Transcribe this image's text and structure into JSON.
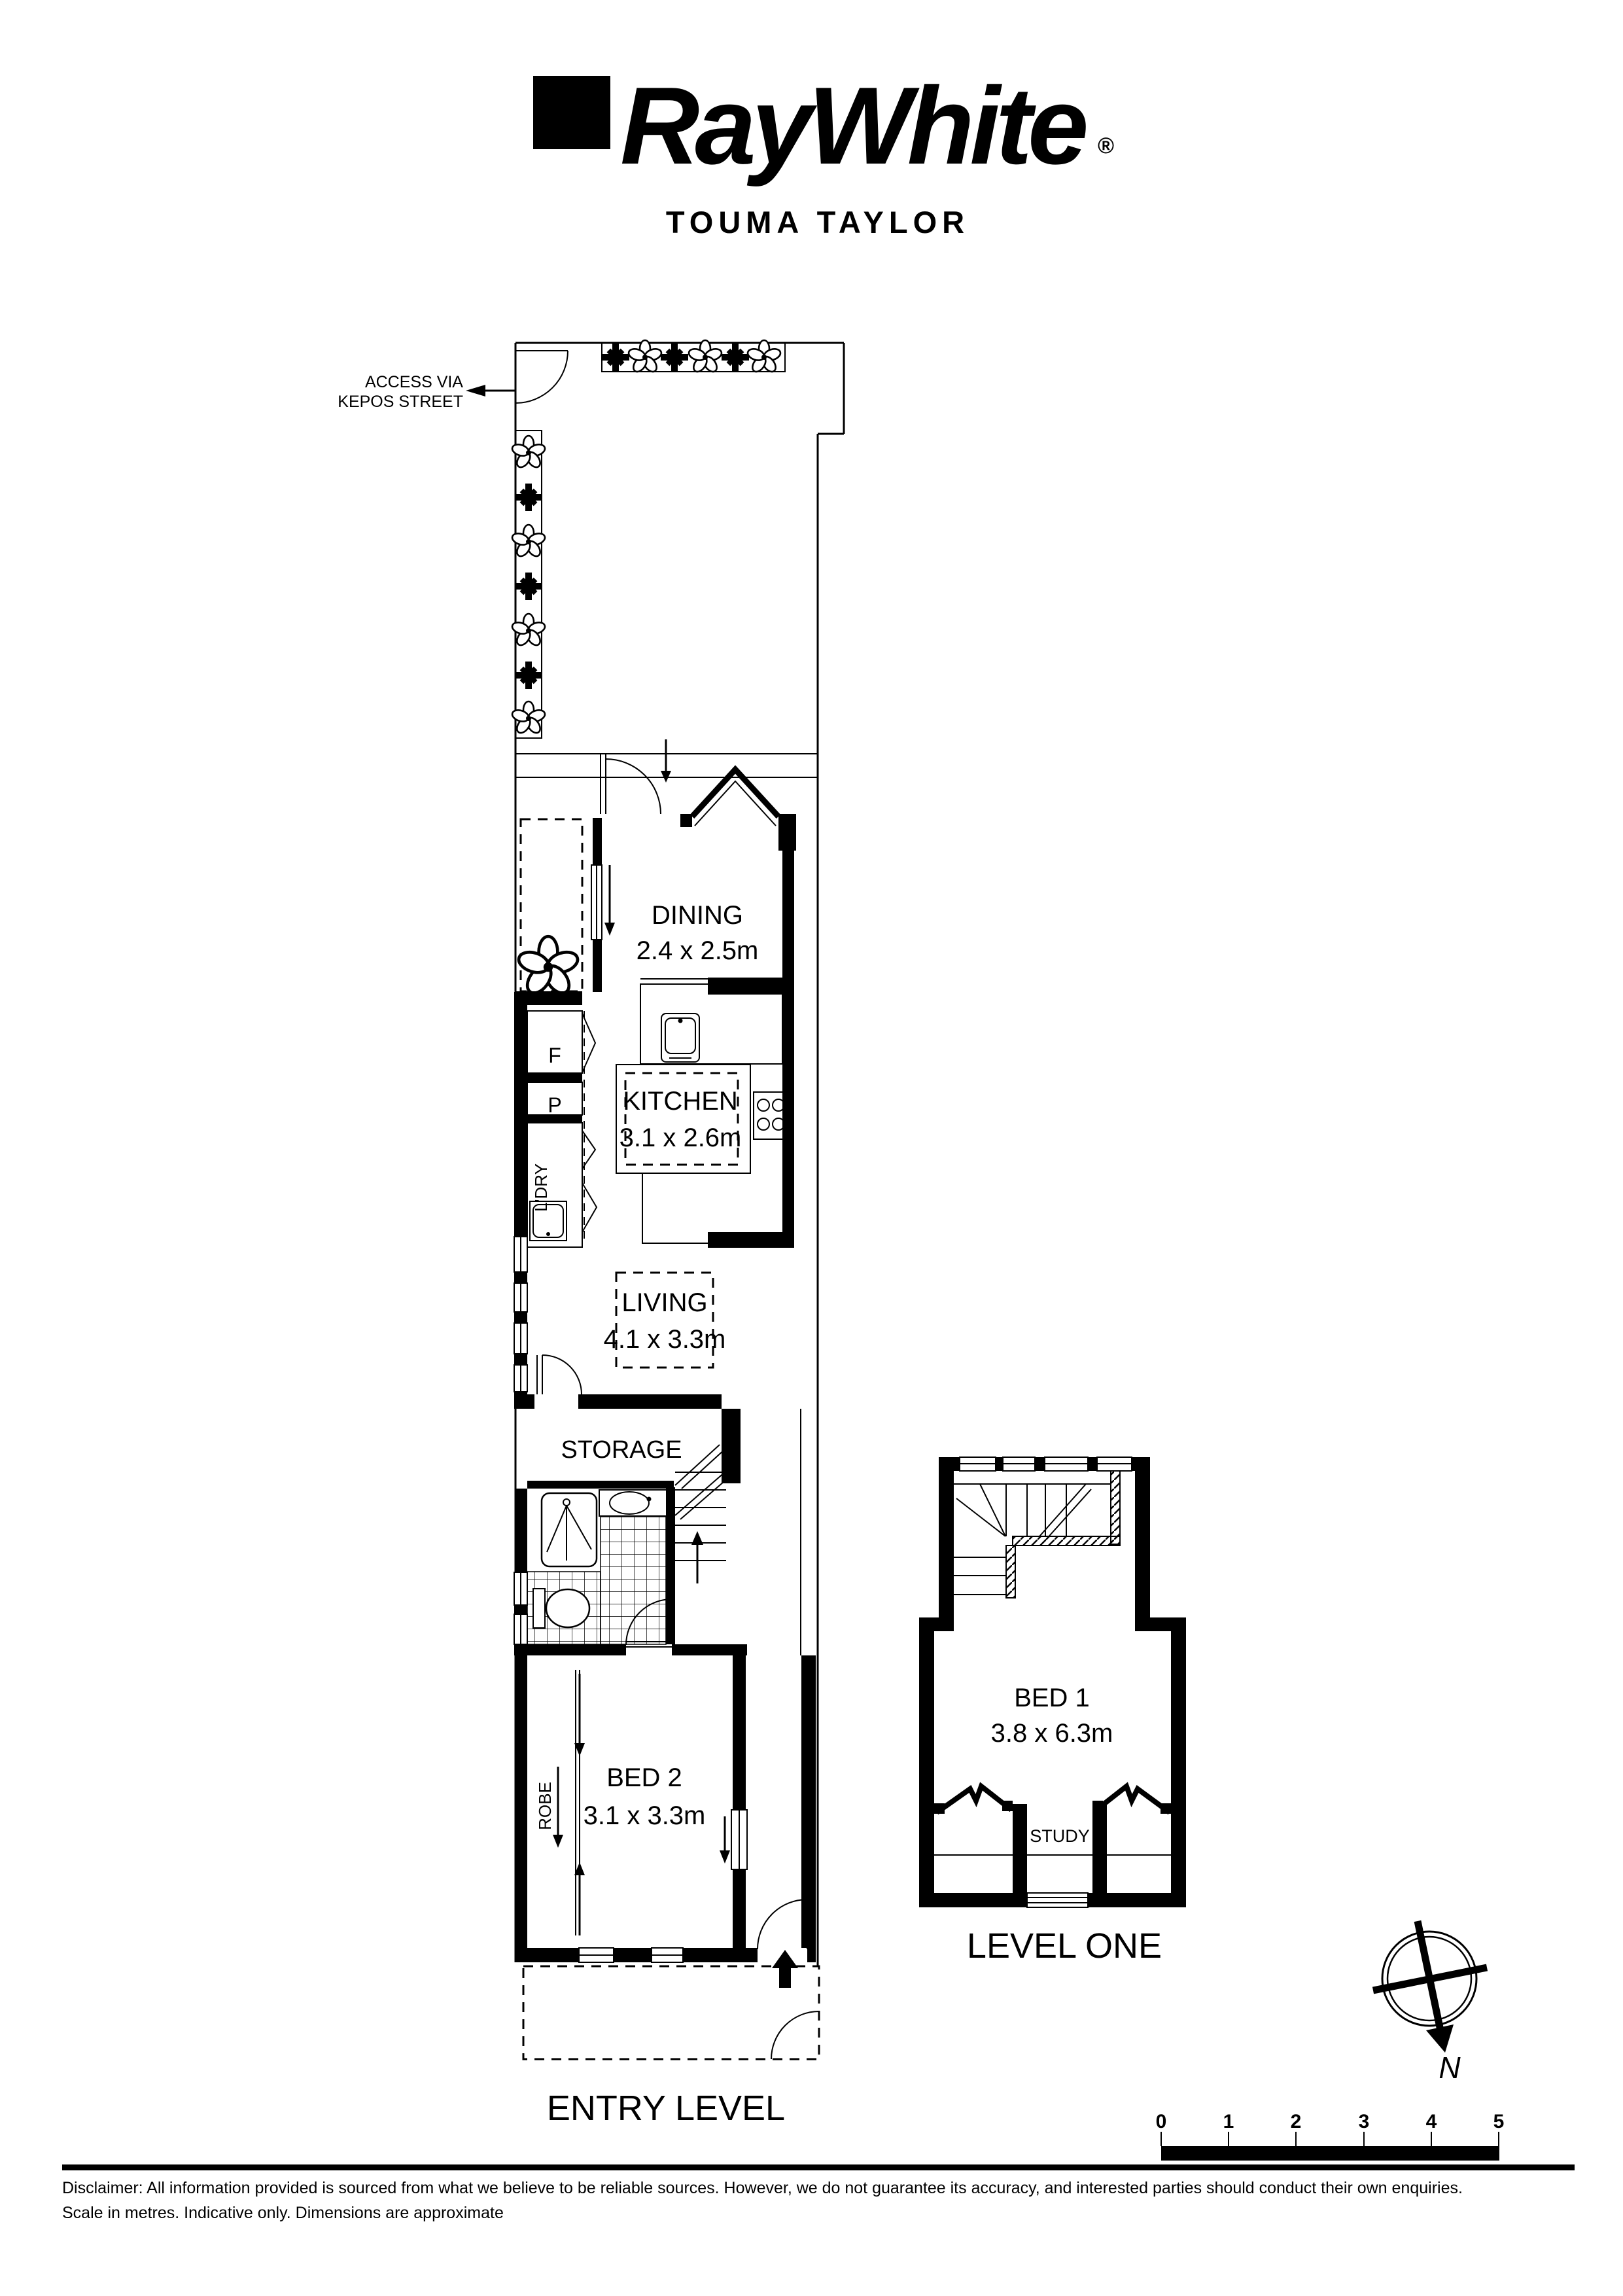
{
  "header": {
    "brand": "RayWhite",
    "registered": "®",
    "agency": "TOUMA TAYLOR"
  },
  "entry_level": {
    "access_line1": "ACCESS VIA",
    "access_line2": "KEPOS STREET",
    "dining_name": "DINING",
    "dining_dims": "2.4 x 2.5m",
    "kitchen_name": "KITCHEN",
    "kitchen_dims": "3.1 x 2.6m",
    "living_name": "LIVING",
    "living_dims": "4.1 x 3.3m",
    "storage_name": "STORAGE",
    "bed2_name": "BED 2",
    "bed2_dims": "3.1 x 3.3m",
    "fridge": "F",
    "pantry": "P",
    "laundry": "L'DRY",
    "robe": "ROBE",
    "label": "ENTRY LEVEL"
  },
  "level_one": {
    "bed1_name": "BED 1",
    "bed1_dims": "3.8 x 6.3m",
    "study": "STUDY",
    "label": "LEVEL ONE"
  },
  "compass": {
    "north": "N"
  },
  "scale_bar": {
    "ticks": [
      "0",
      "1",
      "2",
      "3",
      "4",
      "5"
    ]
  },
  "footer": {
    "disclaimer_line1": "Disclaimer: All information provided is sourced from what we believe to be reliable sources. However, we do not guarantee  its accuracy, and interested parties should conduct their own enquiries.",
    "disclaimer_line2": "Scale in metres. Indicative only. Dimensions are approximate"
  }
}
